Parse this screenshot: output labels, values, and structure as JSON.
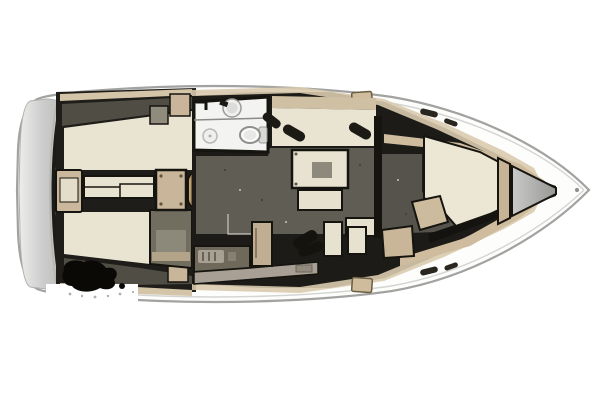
{
  "diagram": {
    "type": "yacht-interior-floor-plan",
    "orientation": "bow-right",
    "background": "#ffffff"
  },
  "palette": {
    "hull_outline": "#a2a2a0",
    "toe_rail": "#d4d4d2",
    "outline_black": "#15140f",
    "bench_cream": "#e9e4d2",
    "berth_cream": "#ece7d5",
    "wood_tan": "#c9b69a",
    "steps_tan": "#c4a87e",
    "deck_tan": "#d9cbae",
    "floor_dark": "#605e54",
    "floor_olive": "#55534b",
    "coaming_olive": "#504e44",
    "bath_white": "#f3f3f1",
    "counter_dark": "#6f695c",
    "counter_light": "#a8a094",
    "fridge_tan": "#c0ae92",
    "quarter_gray": "#716e60",
    "seat_black": "#14130e",
    "locker_gray": "#b5b5b3"
  },
  "parts": [
    "hull",
    "swim-platform",
    "cockpit",
    "cockpit-bench-port",
    "cockpit-bench-starboard",
    "helm-pedestal",
    "cockpit-table",
    "table-pedestal",
    "companionway-steps",
    "head-bathroom",
    "sink",
    "toilet",
    "shower-drain",
    "salon",
    "salon-settee",
    "salon-table",
    "salon-bench",
    "galley",
    "stove",
    "fridge",
    "galley-counter",
    "nav-seat",
    "nav-bench",
    "quarter-berth",
    "bulkhead",
    "forward-cabin",
    "v-berth",
    "vanity-desk",
    "stool",
    "anchor-locker",
    "bow-fitting",
    "deck-hatch",
    "ink-smudge"
  ]
}
